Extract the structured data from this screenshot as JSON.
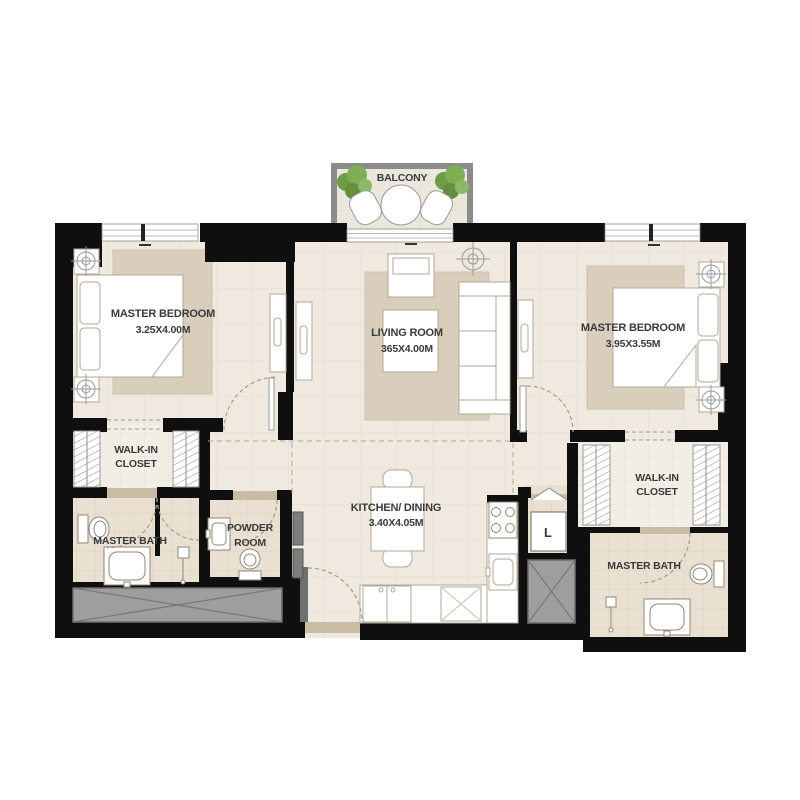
{
  "plan_type": "apartment-floor-plan",
  "colors": {
    "wall": "#0f0f0f",
    "floor": "#efe9df",
    "wet_floor": "#e9e0d2",
    "closet_floor": "#f3eee5",
    "carpet": "#d9cdbb",
    "furniture_outline": "#b2a998",
    "balcony_rail": "#8b8b8b",
    "shaft_fill": "#9e9e9e",
    "plant_green": "#76a04d",
    "threshold": "#c9bba4",
    "label_text": "#3a3a3a"
  },
  "rooms": {
    "balcony": {
      "label": "BALCONY"
    },
    "master_bedroom_left": {
      "label": "MASTER BEDROOM",
      "dimensions": "3.25X4.00M"
    },
    "living_room": {
      "label": "LIVING ROOM",
      "dimensions": "365X4.00M"
    },
    "master_bedroom_right": {
      "label": "MASTER BEDROOM",
      "dimensions": "3.95X3.55M"
    },
    "walk_in_closet_left": {
      "line1": "WALK-IN",
      "line2": "CLOSET"
    },
    "master_bath_left": {
      "label": "MASTER BATH"
    },
    "powder_room": {
      "line1": "POWDER",
      "line2": "ROOM"
    },
    "kitchen_dining": {
      "label": "KITCHEN/ DINING",
      "dimensions": "3.40X4.05M"
    },
    "laundry_closet": {
      "label": "L"
    },
    "walk_in_closet_right": {
      "line1": "WALK-IN",
      "line2": "CLOSET"
    },
    "master_bath_right": {
      "label": "MASTER BATH"
    }
  }
}
